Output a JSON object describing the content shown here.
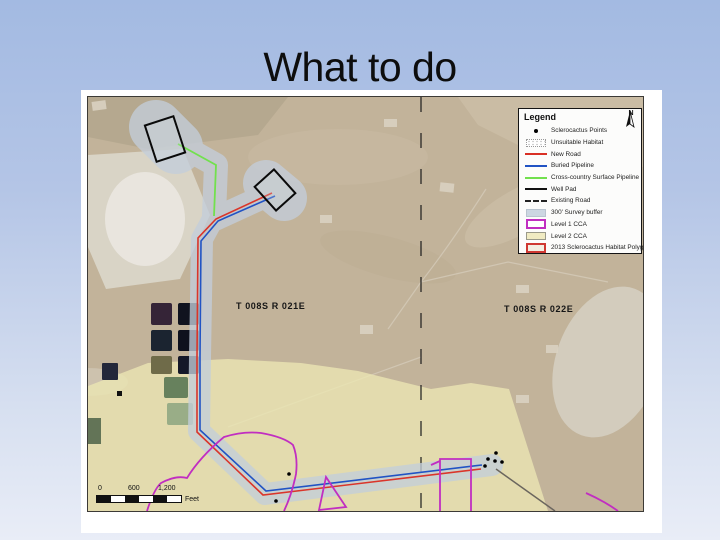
{
  "slide": {
    "title": "What to do"
  },
  "map": {
    "north_label": "N",
    "legend": {
      "title": "Legend",
      "items": [
        {
          "label": "Sclerocactus Points",
          "symbol": "black-point",
          "color": "#000000"
        },
        {
          "label": "Unsuitable Habitat",
          "symbol": "white-dotted-patch",
          "color": "#ffffff"
        },
        {
          "label": "New Road",
          "symbol": "red-line",
          "color": "#d93025"
        },
        {
          "label": "Buried Pipeline",
          "symbol": "blue-line",
          "color": "#2153c4"
        },
        {
          "label": "Cross-country Surface Pipeline",
          "symbol": "green-line",
          "color": "#72e04e"
        },
        {
          "label": "Well Pad",
          "symbol": "black-line",
          "color": "#111111"
        },
        {
          "label": "Existing Road",
          "symbol": "black-dashed-line",
          "color": "#222222"
        },
        {
          "label": "300' Survey buffer",
          "symbol": "light-blue-patch",
          "color": "#ccd7e2"
        },
        {
          "label": "Level 1 CCA",
          "symbol": "magenta-outline-patch",
          "color": "#c12ec1"
        },
        {
          "label": "Level 2 CCA",
          "symbol": "pale-yellow-patch",
          "color": "#f0ebc2"
        },
        {
          "label": "2013 Sclerocactus Habitat Polygon",
          "symbol": "red-outline-patch",
          "color": "#cf3832"
        }
      ]
    },
    "township_labels": {
      "left": "T 008S R 021E",
      "right": "T 008S R 022E"
    },
    "scale_bar": {
      "ticks": [
        "0",
        "600",
        "1,200"
      ],
      "unit": "Feet"
    }
  }
}
